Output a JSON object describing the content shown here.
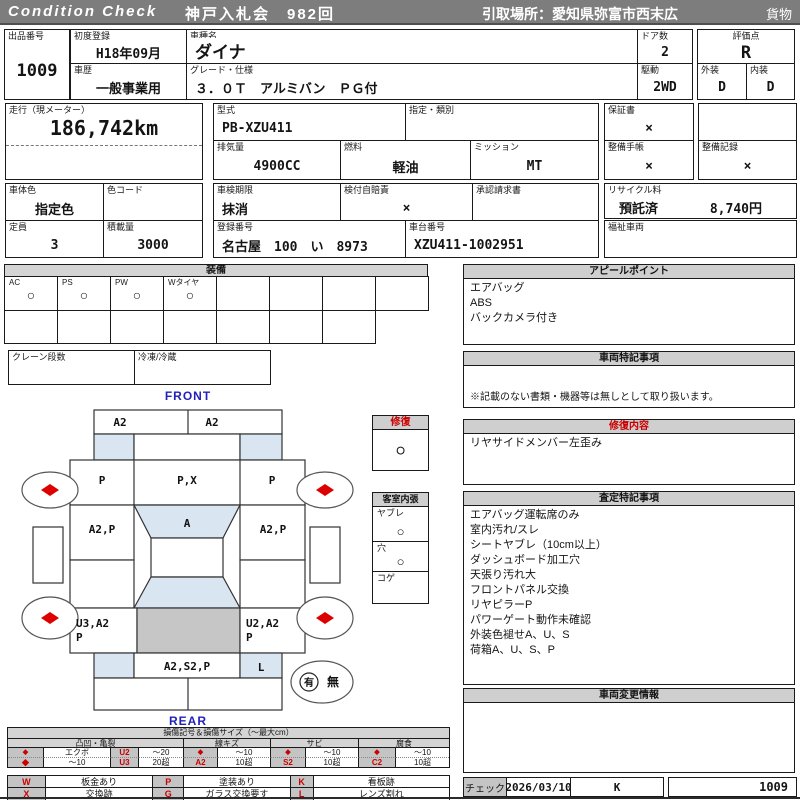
{
  "header": {
    "brand": "Condition  Check",
    "auction": "神戸入札会　982回",
    "pickup": "引取場所：愛知県弥富市西末広",
    "category": "貨物"
  },
  "info": {
    "lot_label": "出品番号",
    "lot": "1009",
    "first_reg_label": "初度登録",
    "first_reg": "H18年09月",
    "history_label": "車歴",
    "history": "一般事業用",
    "model_name_label": "車種名",
    "model_name": "ダイナ",
    "grade_label": "グレード・仕様",
    "grade": "３．０Ｔ　アルミバン　ＰＧ付",
    "doors_label": "ドア数",
    "doors": "2",
    "score_label": "評価点",
    "score": "R",
    "drive_label": "駆動",
    "drive": "2WD",
    "exterior_label": "外装",
    "exterior": "D",
    "interior_label": "内装",
    "interior": "D",
    "mileage_label": "走行（現メーター）",
    "mileage": "186,742km",
    "model_code_label": "型式",
    "model_code": "PB-XZU411",
    "class_label": "指定・類別",
    "class": "",
    "warranty_label": "保証書",
    "warranty": "×",
    "displacement_label": "排気量",
    "displacement": "4900CC",
    "fuel_label": "燃料",
    "fuel": "軽油",
    "transmission_label": "ミッション",
    "transmission": "MT",
    "maint_book_label": "整備手帳",
    "maint_book": "×",
    "maint_record_label": "整備記録",
    "maint_record": "×",
    "body_color_label": "車体色",
    "body_color": "指定色",
    "color_code_label": "色コード",
    "color_code": "",
    "inspection_label": "車検期限",
    "inspection": "抹消",
    "insurance_label": "検付自賠責",
    "insurance": "×",
    "approval_label": "承認請求書",
    "approval": "",
    "recycle_label": "リサイクル料",
    "recycle_status": "預託済",
    "recycle_fee": "8,740円",
    "capacity_label": "定員",
    "capacity": "3",
    "load_label": "積載量",
    "load": "3000",
    "reg_number_label": "登録番号",
    "reg_number": "名古屋　100　い　8973",
    "chassis_label": "車台番号",
    "chassis": "XZU411-1002951",
    "welfare_label": "福祉車両",
    "welfare": ""
  },
  "equipment": {
    "title": "装備",
    "items": [
      {
        "label": "AC",
        "mark": "○"
      },
      {
        "label": "PS",
        "mark": "○"
      },
      {
        "label": "PW",
        "mark": "○"
      },
      {
        "label": "Wタイヤ",
        "mark": "○"
      }
    ],
    "crane_label": "クレーン段数",
    "crane": "",
    "freezer_label": "冷凍/冷蔵",
    "freezer": ""
  },
  "diagram": {
    "front_label": "FRONT",
    "rear_label": "REAR",
    "front_bumper_left": "A2",
    "front_bumper_right": "A2",
    "roof_left": "P",
    "roof_center": "P,X",
    "roof_right": "P",
    "door_left": "A2,P",
    "hood": "A",
    "door_right": "A2,P",
    "bed_left_line1": "U3,A2",
    "bed_left_line2": "P",
    "bed_right_line1": "U2,A2",
    "bed_right_line2": "P",
    "rear_bumper_center": "A2,S2,P",
    "rear_corner_right": "L",
    "spare_yes": "有",
    "spare_no": "無"
  },
  "repair_panel": {
    "title": "修復",
    "mark": "○"
  },
  "interior_panel": {
    "title": "客室内張",
    "items": [
      {
        "label": "ヤブレ",
        "mark": "○"
      },
      {
        "label": "穴",
        "mark": "○"
      },
      {
        "label": "コゲ",
        "mark": ""
      }
    ]
  },
  "appeal": {
    "title": "アピールポイント",
    "lines": [
      "エアバッグ",
      "ABS",
      "バックカメラ付き"
    ]
  },
  "vehicle_notes": {
    "title": "車両特記事項",
    "note": "※記載のない書類・機器等は無しとして取り扱います。"
  },
  "repair_details": {
    "title": "修復内容",
    "lines": [
      "リヤサイドメンバー左歪み"
    ]
  },
  "assessment": {
    "title": "査定特記事項",
    "lines": [
      "エアバッグ運転席のみ",
      "室内汚れ/スレ",
      "シートヤブレ（10cm以上）",
      "ダッシュボード加工穴",
      "天張り汚れ大",
      "フロントパネル交換",
      "リヤピラーP",
      "パワーゲート動作未確認",
      "外装色褪せA、U、S",
      "荷箱A、U、S、P"
    ]
  },
  "change_info": {
    "title": "車両変更情報"
  },
  "check": {
    "label": "チェック",
    "date": "2026/03/10",
    "inspector": "K",
    "lot": "1009"
  },
  "legend": {
    "title": "損傷記号＆損傷サイズ（～最大cm）",
    "groups": [
      "凸凹・亀裂",
      "線キズ",
      "サビ",
      "腐食"
    ],
    "row1": {
      "d1": "◆",
      "n1": "エクボ",
      "c1": "U2",
      "s1": "～20",
      "d2": "◆",
      "s2": "～10",
      "d3": "◆",
      "s3": "～10",
      "d4": "◆",
      "s4": "～10"
    },
    "row2": {
      "d1": "◆",
      "n1": "～10",
      "c1": "U3",
      "s1": "20超",
      "c2": "A2",
      "s2": "10超",
      "c3": "S2",
      "s3": "10超",
      "c4": "C2",
      "s4": "10超"
    },
    "row3": {
      "c1": "W",
      "v1": "板金あり",
      "c2": "P",
      "v2": "塗装あり",
      "c3": "K",
      "v3": "看板跡"
    },
    "row4": {
      "c1": "X",
      "v1": "交換跡",
      "c2": "G",
      "v2": "ガラス交換要す",
      "c3": "L",
      "v3": "レンズ割れ"
    }
  }
}
